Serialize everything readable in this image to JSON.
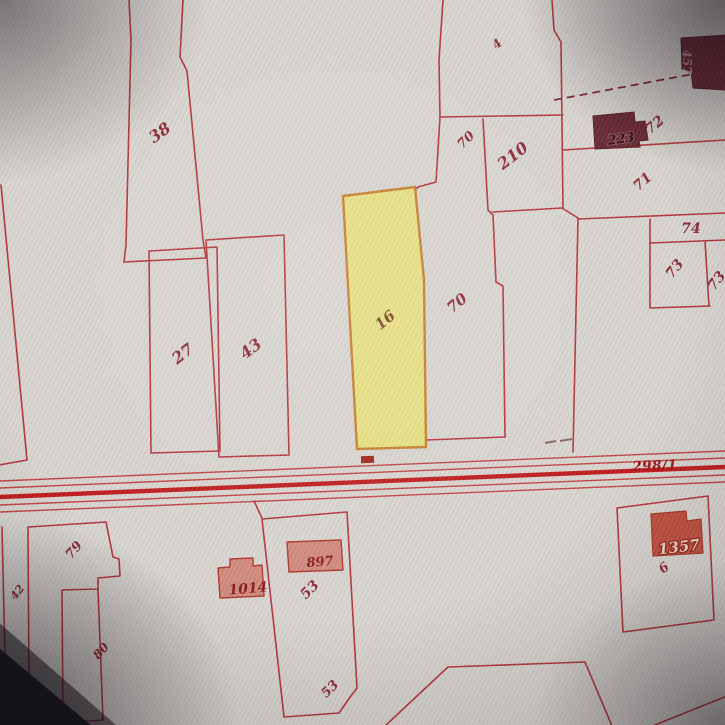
{
  "app": {
    "type": "cadastral-map-viewer",
    "view": "parcel-map-photo"
  },
  "map": {
    "selected_parcel": "16",
    "road_parcel": "298/1",
    "colors": {
      "paper": "#d9d5d0",
      "parcel_line": "#b5373c",
      "road_thick": "#c11d1d",
      "highlight_fill": "#e8e17c",
      "highlight_border": "#c8802e",
      "building_fill": "#d28b80",
      "building_strong_fill": "#c05140",
      "building_dark_fill": "#6b2a33",
      "label_color": "#8e2b34"
    },
    "labels": {
      "p38": "38",
      "p4": "4",
      "p70_upper": "70",
      "p210": "210",
      "p72": "72",
      "p71": "71",
      "p74": "74",
      "p73_left": "73",
      "p73_right": "73",
      "p27": "27",
      "p43": "43",
      "p16": "16",
      "p70": "70",
      "road": "298/1",
      "p79": "79",
      "p42": "42",
      "p80": "80",
      "p53_upper": "53",
      "p53_lower": "53",
      "p6": "6",
      "b457": "457",
      "b223": "223",
      "b1014": "1014",
      "b897": "897",
      "b1357": "1357"
    }
  }
}
